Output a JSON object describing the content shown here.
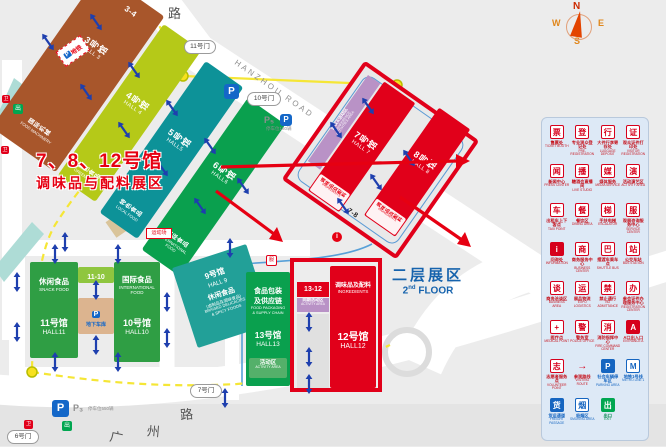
{
  "annotation": {
    "line1": "7、8、12号馆",
    "line2": "调味品与配料展区"
  },
  "floor2": {
    "zh": "二层展区",
    "en_num": "2",
    "en_sup": "nd",
    "en_word": "FLOOR"
  },
  "compass": {
    "n": "N",
    "e": "E",
    "s": "S",
    "w": "W"
  },
  "roads": {
    "hangzhou": "HANZHOU ROAD",
    "top": "路",
    "guangzhou": [
      "广",
      "州",
      "路"
    ]
  },
  "gates": {
    "g11": "11号门",
    "g10": "10号门",
    "g7": "7号门",
    "g6": "6号门"
  },
  "parking": {
    "p_icon": "P",
    "p5": "P₅",
    "p5_note": "停车位180辆",
    "p3": "P₃",
    "p3_note": "停车位550辆",
    "underground": "地下车库"
  },
  "metro_badge": {
    "p": "P",
    "label": "地铁"
  },
  "info_icon": "i",
  "sports_tag": "运动场",
  "areas": {
    "conference": {
      "zh": "会议&活动区",
      "en1": "CONFERENCE",
      "en2": "ACTIVITIES AREA"
    },
    "activity1312": {
      "zh": "同期活动区",
      "en": "ACTIVITY AREA"
    },
    "hall13_activity": {
      "zh": "活动区",
      "en": "ACTIVITY AREA"
    }
  },
  "halls": {
    "hall3": {
      "name": "3号馆",
      "en": "HALL 3",
      "cat_zh": "国际机械",
      "cat_en": "FOOD MACHINERY",
      "link": "3-4"
    },
    "hall4": {
      "name": "4号馆",
      "en": "HALL 4",
      "cat_zh": "绿色食品",
      "cat_en": "GREEN FOOD"
    },
    "hall5": {
      "name": "5号馆",
      "en": "HALL5",
      "cat_zh": "特色食品",
      "cat_en": "LOCAL FOOD"
    },
    "hall6": {
      "name": "6号馆",
      "en": "HALL6",
      "cat_zh": "国际食品",
      "cat_en": "INTERNATIONAL FOOD"
    },
    "hall7": {
      "name": "7号馆",
      "en": "HALL 7",
      "cat_zh": "调味品及配料",
      "cat_en": "INGREDIENTS"
    },
    "hall8": {
      "name": "8号馆",
      "en": "HALL 8",
      "cat_zh": "调味品及配料",
      "cat_en": "INGREDIENTS",
      "link": "7-8"
    },
    "hall9": {
      "name": "9号馆",
      "en": "HALL 9",
      "cat_zh": "休闲食品",
      "cat_sub": "(卤制品及调味食品)",
      "cat_en1": "BRAISED DELICACIES",
      "cat_en2": "& SPICY FOODS"
    },
    "hall10": {
      "name": "10号馆",
      "en": "HALL10",
      "cat_zh": "国际食品",
      "cat_en1": "INTERNATIONAL",
      "cat_en2": "FOOD"
    },
    "hall11": {
      "name": "11号馆",
      "en": "HALL11",
      "cat_zh": "休闲食品",
      "cat_en": "SNACK FOOD",
      "link": "11-10"
    },
    "hall12": {
      "name": "12号馆",
      "en": "HALL12",
      "cat_zh": "调味品及配料",
      "cat_en": "INGREDIENTS",
      "link": "13-12"
    },
    "hall13": {
      "name": "13号馆",
      "en": "HALL13",
      "cat_zh1": "食品包装",
      "cat_zh2": "及供应链",
      "cat_en1": "FOOD PACKAGING",
      "cat_en2": "& SUPPLY CHAIN"
    }
  },
  "legend": {
    "items": [
      {
        "zh": "售票处",
        "en": "TICKET BOOTH",
        "glyph": "票",
        "style": "red"
      },
      {
        "zh": "专业观众登记处",
        "en": "PRE-REGISTRATION",
        "glyph": "登",
        "style": "red"
      },
      {
        "zh": "大件行李寄存处",
        "en": "LUGGAGE DEPOSIT",
        "glyph": "行",
        "style": "red"
      },
      {
        "zh": "观众证件打印处",
        "en": "VISITOR REGISTRATION",
        "glyph": "证",
        "style": "red"
      },
      {
        "zh": "新闻中心",
        "en": "PRESS CENTER",
        "glyph": "闻",
        "style": "red"
      },
      {
        "zh": "糖酒会直播间",
        "en": "LIVE STUDIO",
        "glyph": "播",
        "style": "red"
      },
      {
        "zh": "媒体服务",
        "en": "MEDIA SERVICE",
        "glyph": "媒",
        "style": "red"
      },
      {
        "zh": "活动演艺区",
        "en": "ACTIVITY AREA",
        "glyph": "演",
        "style": "red"
      },
      {
        "zh": "出租车上下客点",
        "en": "TAXI POINT",
        "glyph": "车",
        "style": "red"
      },
      {
        "zh": "餐饮区",
        "en": "DINING AREA",
        "glyph": "餐",
        "style": "red"
      },
      {
        "zh": "手扶电梯",
        "en": "ESCALATOR",
        "glyph": "梯",
        "style": "red"
      },
      {
        "zh": "观展咨询服务中心",
        "en": "SERVICE CENTER",
        "glyph": "服",
        "style": "red"
      },
      {
        "zh": "问询处",
        "en": "INFORMATION",
        "glyph": "i",
        "style": "red-filled"
      },
      {
        "zh": "商务服务中心",
        "en": "BUSINESS CENTER",
        "glyph": "商",
        "style": "red"
      },
      {
        "zh": "摆渡车乘车点",
        "en": "SHUTTLE BUS",
        "glyph": "巴",
        "style": "red"
      },
      {
        "zh": "公交车站",
        "en": "BUS STATION",
        "glyph": "站",
        "style": "red"
      },
      {
        "zh": "商务洽谈区",
        "en": "BUSINESS AREA",
        "glyph": "谈",
        "style": "red"
      },
      {
        "zh": "展品物流",
        "en": "EXPO LOGISTICS",
        "glyph": "运",
        "style": "red"
      },
      {
        "zh": "禁止通行",
        "en": "NO ADMITTANCE",
        "glyph": "禁",
        "style": "red"
      },
      {
        "zh": "参会证件办理服务中心",
        "en": "REGISTRATION CENTER",
        "glyph": "办",
        "style": "red"
      },
      {
        "zh": "医疗点",
        "en": "MEDICAL POINT",
        "glyph": "+",
        "style": "red"
      },
      {
        "zh": "警务室",
        "en": "POLICE OFFICE",
        "glyph": "警",
        "style": "red"
      },
      {
        "zh": "消防指挥中心",
        "en": "FIRE COMMAND CENTER",
        "glyph": "消",
        "style": "red"
      },
      {
        "zh": "A口出入口",
        "en": "ENTRANCE A",
        "glyph": "A",
        "style": "red-filled"
      },
      {
        "zh": "志愿者服务点",
        "en": "VOLUNTEER POINT",
        "glyph": "志",
        "style": "red"
      },
      {
        "zh": "参观路线",
        "en": "VISITING ROUTE",
        "glyph": "→",
        "style": "route"
      },
      {
        "zh": "社会车辆停车区",
        "en": "PARKING AREA",
        "glyph": "P",
        "style": "blue-filled",
        "cls": "b"
      },
      {
        "zh": "地铁1号线",
        "en": "METRO LINE 1",
        "glyph": "M",
        "style": "blue",
        "cls": "b"
      },
      {
        "zh": "货运通道",
        "en": "FREIGHT PASSAGE",
        "glyph": "货",
        "style": "blue-filled",
        "cls": "b"
      },
      {
        "zh": "吸烟区",
        "en": "SMOKING AREA",
        "glyph": "烟",
        "style": "blue",
        "cls": "b"
      },
      {
        "zh": "出口",
        "en": "EXIT",
        "glyph": "出",
        "style": "green-filled",
        "cls": "g"
      }
    ]
  }
}
